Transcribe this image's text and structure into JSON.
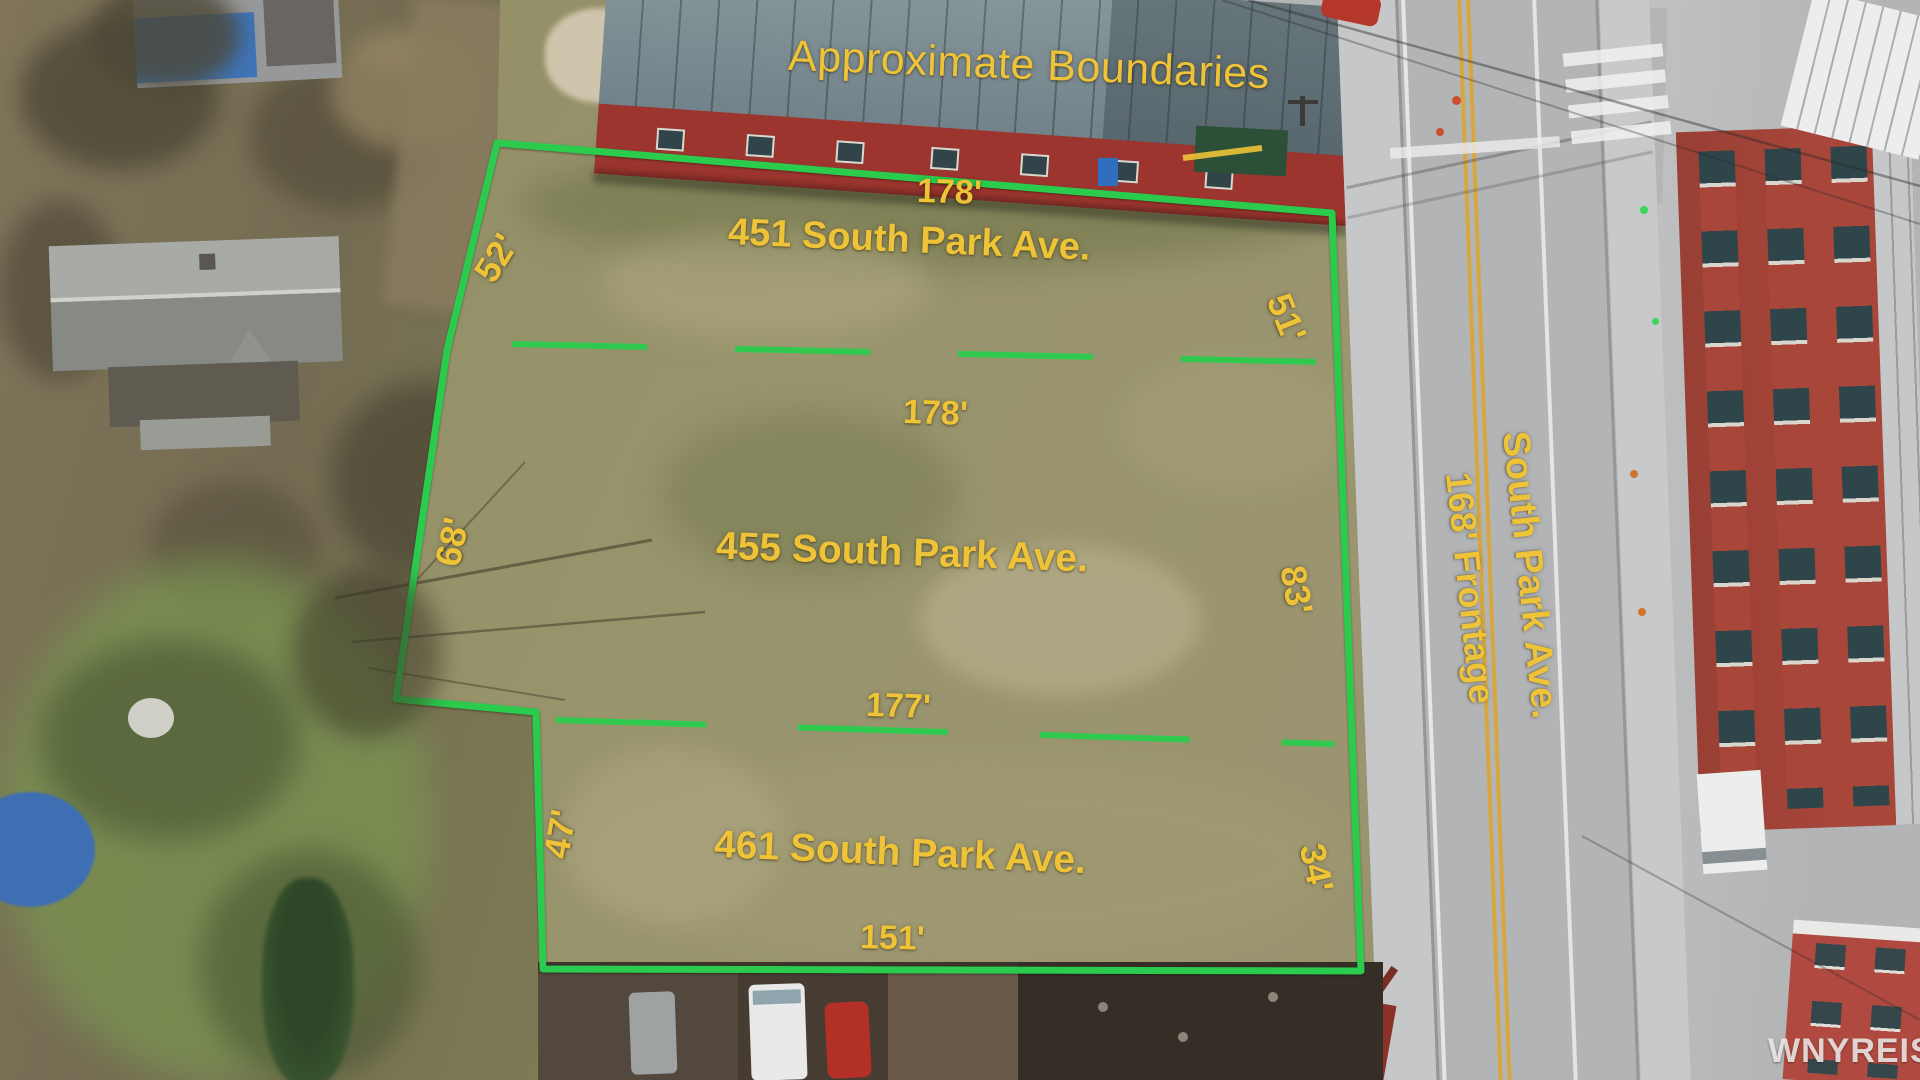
{
  "annotation": {
    "title": "Approximate Boundaries",
    "lots": [
      {
        "address": "451 South Park Ave.",
        "top_width": "178'",
        "left_side": "52'",
        "right_side": "51'"
      },
      {
        "address": "455 South Park Ave.",
        "top_width": "178'",
        "left_side": "68'",
        "right_side": "83'"
      },
      {
        "address": "461 South Park Ave.",
        "top_width": "177'",
        "left_side": "47'",
        "right_side": "34'",
        "bottom_width": "151'"
      }
    ],
    "road": {
      "name": "South Park Ave.",
      "frontage": "168' Frontage"
    },
    "watermark": "WNYREIS",
    "colors": {
      "annotation_yellow": "#EFC337",
      "boundary_green": "#2BCC4E",
      "field_olive": "#95916A",
      "road_gray": "#B2B4B5",
      "barn_red": "#9C352E",
      "building_red": "#A8463A"
    }
  }
}
